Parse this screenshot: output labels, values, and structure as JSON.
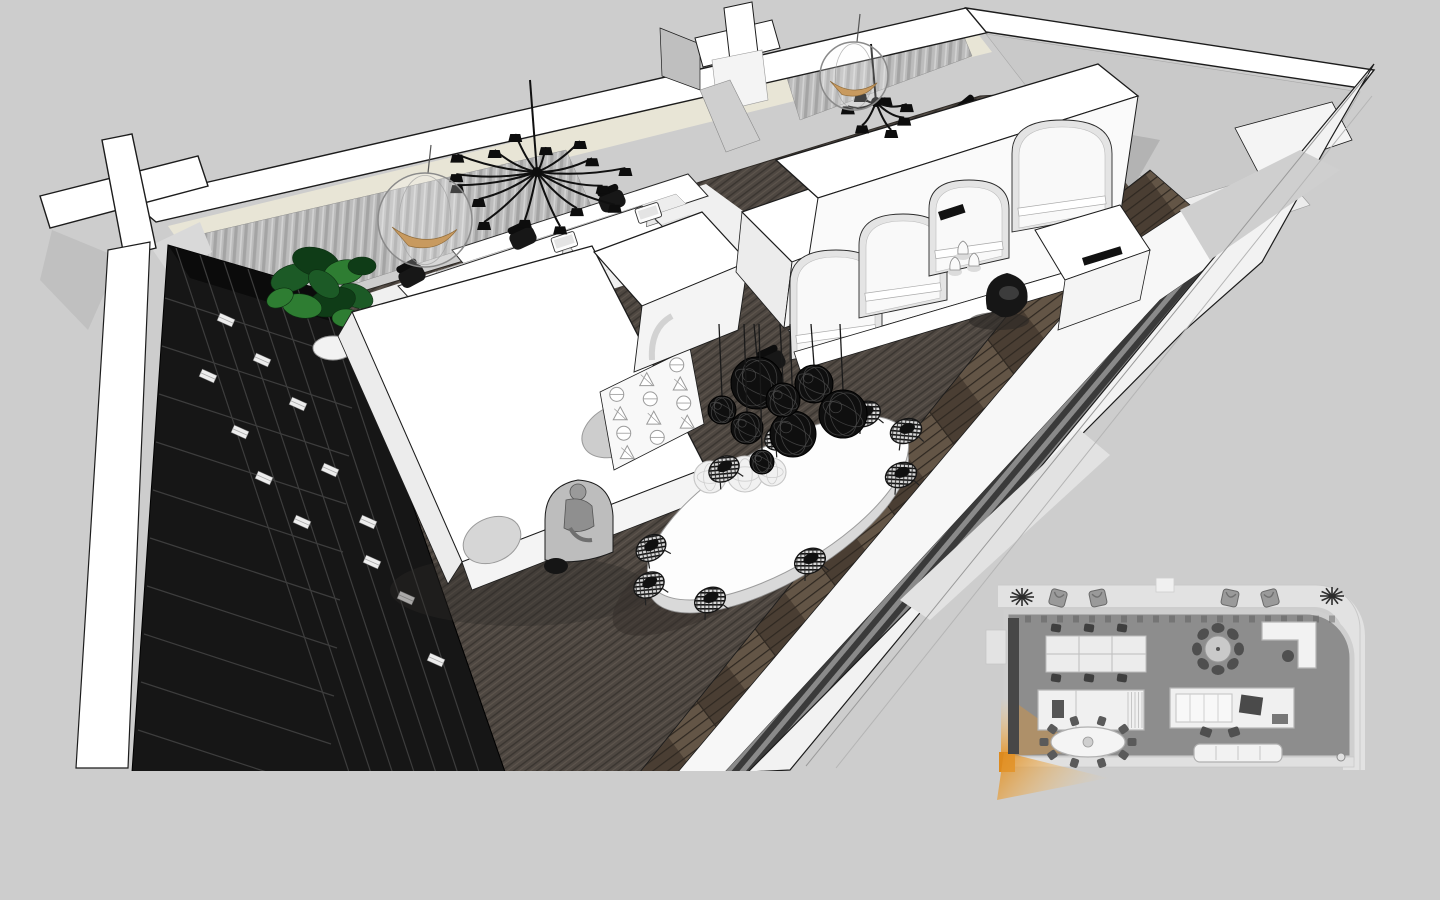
{
  "scene": {
    "type": "3d-sketchup-office-render",
    "description": "Axonometric cutaway rendering of a long narrow office interior (black-and-white scheme) with dark carpet, white arched pods, workstations, oval meeting table under black wire pendant lamps, black grid bookshelf, and an inset floor plan with orange camera view-cone at bottom right",
    "colors": {
      "background": "#cdcdcd",
      "line": "#1c1c1c",
      "white": "#ffffff",
      "cut_white": "#f4f4f4",
      "light": "#ececec",
      "mid_gray": "#c9c9c9",
      "dark_gray": "#b3b3b3",
      "carpet": "#4e4741",
      "carpet_streak_dark": "#3a3530",
      "carpet_streak_light": "#5f574f",
      "wood": "#4a3e33",
      "wood_light": "#635546",
      "wood_seam": "#2f2821",
      "slat_dark": "#3a3a3a",
      "slat_base": "#8a8a8a",
      "curtain": "#bcbcbc",
      "curtain_dark": "#a4a4a4",
      "curtain_light": "#d2d2d2",
      "clerestory": "#e8e5d6",
      "shelf_black": "#161616",
      "shelf_line": "#3d3d3d",
      "book_white": "#ededed",
      "plant_green": "#1c5a26",
      "plant_dark": "#0f3c17",
      "plant_light": "#2e7d32",
      "lamp_black": "#0f0f0f",
      "figure_gray": "#9a9a9a",
      "amber": "#c89a5f",
      "plan_wall": "#e2e2e2",
      "plan_floor": "#8d8d8d",
      "plan_furniture": "#f0f0f0",
      "plan_dark_item": "#4a4a4a",
      "plan_shelf": "#474747",
      "orange": "#e5962f",
      "orange_deep": "#dd8a1e",
      "orange_pale": "#f5c87e"
    }
  },
  "main_view": {
    "chandelier_large": {
      "cx": 537,
      "cy": 172,
      "stem_x": 530,
      "stem_y": 80,
      "arms": [
        [
          -170,
          82
        ],
        [
          -148,
          94
        ],
        [
          -126,
          72
        ],
        [
          -104,
          90
        ],
        [
          -82,
          64
        ],
        [
          -60,
          86
        ],
        [
          -38,
          70
        ],
        [
          -16,
          92
        ],
        [
          6,
          66
        ],
        [
          28,
          88
        ],
        [
          50,
          62
        ],
        [
          74,
          84
        ],
        [
          100,
          70
        ],
        [
          126,
          90
        ],
        [
          152,
          66
        ],
        [
          176,
          80
        ]
      ]
    },
    "chandelier_small": {
      "cx": 876,
      "cy": 102,
      "stem_x": 871,
      "stem_y": 44,
      "arms": [
        [
          -160,
          30
        ],
        [
          -115,
          36
        ],
        [
          -70,
          28
        ],
        [
          -25,
          34
        ],
        [
          20,
          30
        ],
        [
          65,
          36
        ],
        [
          120,
          28
        ]
      ]
    },
    "hanging_bubble_chairs": [
      {
        "cx": 425,
        "cy": 220,
        "r": 47
      },
      {
        "cx": 854,
        "cy": 76,
        "r": 34
      }
    ],
    "pendant_lamps": {
      "cord_top": 324,
      "spheres": [
        {
          "x": 757,
          "y": 383,
          "r": 26
        },
        {
          "x": 814,
          "y": 384,
          "r": 19
        },
        {
          "x": 843,
          "y": 414,
          "r": 24
        },
        {
          "x": 793,
          "y": 434,
          "r": 23
        },
        {
          "x": 747,
          "y": 428,
          "r": 16
        },
        {
          "x": 722,
          "y": 410,
          "r": 14
        },
        {
          "x": 783,
          "y": 400,
          "r": 17
        },
        {
          "x": 762,
          "y": 462,
          "r": 12
        }
      ],
      "table_shadows": [
        {
          "x": 710,
          "y": 477,
          "r": 16
        },
        {
          "x": 745,
          "y": 474,
          "r": 18
        },
        {
          "x": 772,
          "y": 472,
          "r": 14
        }
      ]
    },
    "dining_chairs": [
      [
        906,
        431,
        -20
      ],
      [
        865,
        414,
        -25
      ],
      [
        780,
        437,
        -30
      ],
      [
        724,
        469,
        -30
      ],
      [
        651,
        548,
        -35
      ],
      [
        649,
        585,
        -30
      ],
      [
        710,
        600,
        -25
      ],
      [
        810,
        561,
        -25
      ],
      [
        901,
        475,
        -22
      ]
    ],
    "desk_monitors": [
      [
        567,
        250
      ],
      [
        651,
        221
      ],
      [
        852,
        308
      ]
    ],
    "desk_chairs": [
      [
        412,
        276,
        -28
      ],
      [
        523,
        238,
        -25
      ],
      [
        612,
        201,
        -22
      ],
      [
        972,
        112,
        -40
      ],
      [
        772,
        362,
        -25
      ]
    ],
    "shelf_books": [
      [
        226,
        320
      ],
      [
        262,
        360
      ],
      [
        298,
        404
      ],
      [
        240,
        432
      ],
      [
        208,
        376
      ],
      [
        330,
        470
      ],
      [
        368,
        522
      ],
      [
        302,
        522
      ],
      [
        264,
        478
      ],
      [
        406,
        598
      ],
      [
        372,
        562
      ],
      [
        436,
        660
      ]
    ],
    "screen_panel": {
      "corners": [
        [
          600,
          392
        ],
        [
          690,
          348
        ],
        [
          704,
          424
        ],
        [
          614,
          470
        ]
      ],
      "cols": 3,
      "rows": 4
    },
    "arcade_arches": [
      [
        836,
        250,
        46,
        110
      ],
      [
        903,
        214,
        44,
        104
      ],
      [
        969,
        180,
        40,
        96
      ],
      [
        1062,
        120,
        50,
        112
      ]
    ],
    "plant": {
      "cx": 322,
      "cy": 296,
      "leaves": [
        [
          -30,
          -18,
          22,
          13,
          -20,
          0
        ],
        [
          -6,
          -34,
          24,
          14,
          15,
          1
        ],
        [
          22,
          -24,
          20,
          12,
          -10,
          2
        ],
        [
          34,
          0,
          18,
          11,
          25,
          0
        ],
        [
          10,
          6,
          24,
          14,
          -15,
          1
        ],
        [
          -20,
          10,
          20,
          12,
          10,
          2
        ],
        [
          40,
          -30,
          14,
          9,
          0,
          1
        ],
        [
          -42,
          2,
          14,
          9,
          -25,
          2
        ],
        [
          2,
          -12,
          18,
          11,
          40,
          0
        ],
        [
          24,
          22,
          14,
          9,
          0,
          2
        ]
      ]
    },
    "human_figure": {
      "x": 578,
      "y": 470
    },
    "vases": [
      [
        963,
        250
      ],
      [
        974,
        262
      ],
      [
        955,
        266
      ]
    ],
    "lounge_chair": {
      "x": 1007,
      "y": 295
    }
  },
  "inset_plan": {
    "terrace_chairs": [
      [
        1058,
        598,
        15
      ],
      [
        1098,
        598,
        -12
      ],
      [
        1230,
        598,
        12
      ],
      [
        1270,
        598,
        -15
      ]
    ],
    "plants": [
      [
        1022,
        597
      ],
      [
        1332,
        596
      ]
    ],
    "desk_chairs": [
      [
        1056,
        628
      ],
      [
        1089,
        628
      ],
      [
        1122,
        628
      ],
      [
        1056,
        678
      ],
      [
        1089,
        678
      ],
      [
        1122,
        678
      ]
    ],
    "oval_table": {
      "cx": 1088,
      "cy": 742,
      "rx": 37,
      "ry": 15,
      "chairs": 10
    },
    "round_table": {
      "cx": 1218,
      "cy": 649,
      "r": 13,
      "chairs": 8
    },
    "sofa_chairs": [
      [
        1206,
        732,
        20
      ],
      [
        1234,
        732,
        -18
      ]
    ]
  },
  "objects": [
    {
      "name": "cross-column",
      "label": "sectioned cross-shaped structural column"
    },
    {
      "name": "back-wall",
      "label": "window wall with gray curtains and cream clerestory"
    },
    {
      "name": "black-bookshelf",
      "label": "black grid bookshelf wall with white books"
    },
    {
      "name": "potted-plant",
      "label": "green potted plant"
    },
    {
      "name": "workstations",
      "label": "white desks with monitors and black task chairs"
    },
    {
      "name": "spider-chandelier",
      "label": "black multi-arm chandelier"
    },
    {
      "name": "bubble-chair",
      "label": "hanging transparent bubble chair with amber cushion"
    },
    {
      "name": "cave-pod",
      "label": "white pod with round cutouts and seated figure"
    },
    {
      "name": "perforated-screen",
      "label": "white screen with circle and triangle perforations"
    },
    {
      "name": "arched-arcade",
      "label": "white arcade volume with arched openings"
    },
    {
      "name": "oval-table",
      "label": "white oval meeting table"
    },
    {
      "name": "wire-chairs",
      "label": "black woven wire chairs"
    },
    {
      "name": "pendant-cluster",
      "label": "cluster of black random-wire pendant spheres"
    },
    {
      "name": "lounge-chair",
      "label": "black sculptural lounge chair"
    },
    {
      "name": "floor-plan-inset",
      "label": "floor plan inset with orange camera view cone"
    }
  ]
}
